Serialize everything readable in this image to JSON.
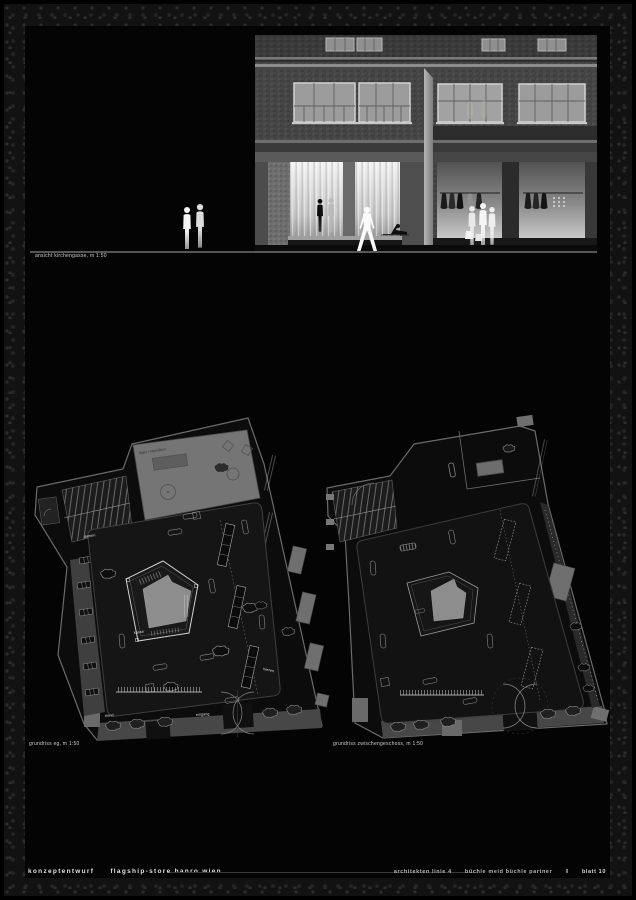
{
  "sheet": {
    "type": "architectural presentation board",
    "colors": {
      "background": "#040404",
      "line_white": "#e0e0e0",
      "wall_gray": "#757575",
      "floor_black": "#121212"
    }
  },
  "elevation": {
    "caption": "ansicht kirchengasse, m 1:50"
  },
  "plans": {
    "left": {
      "caption": "grundriss eg, m 1:50",
      "labels": {
        "zone": "lager / expedition",
        "damen": "damen",
        "kassa": "kassa",
        "herren": "herren",
        "trend": "trend",
        "eingang": "eingang"
      }
    },
    "right": {
      "caption": "grundriss zwischengeschoss, m 1:50"
    }
  },
  "footer": {
    "project": "konzeptentwurf",
    "subtitle": "flagship-store hanro wien",
    "firm": "architekten linie 4",
    "partners": "büchle meid büchle partner",
    "separator": "‖",
    "sheet_no": "blatt 10"
  }
}
